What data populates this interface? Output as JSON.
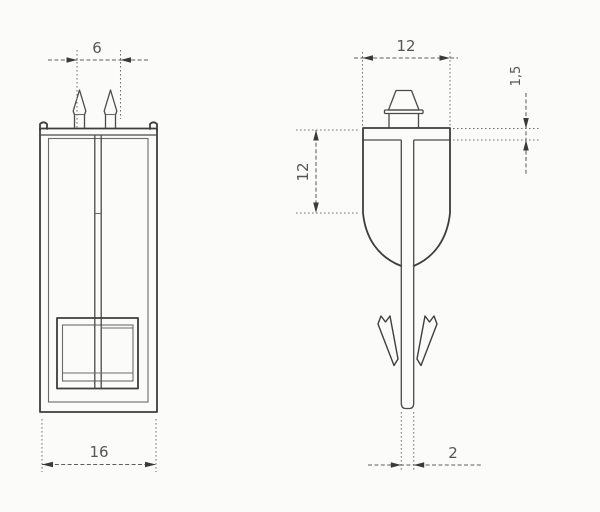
{
  "drawing": {
    "kind": "fastener-clip-two-view-technical-drawing",
    "front_view": {
      "dim_pin_span": "6",
      "dim_overall_width": "16"
    },
    "side_view": {
      "dim_head_width": "12",
      "dim_plate_thickness": "1,5",
      "dim_upper_body_length": "12",
      "dim_stem_thickness": "2"
    }
  }
}
